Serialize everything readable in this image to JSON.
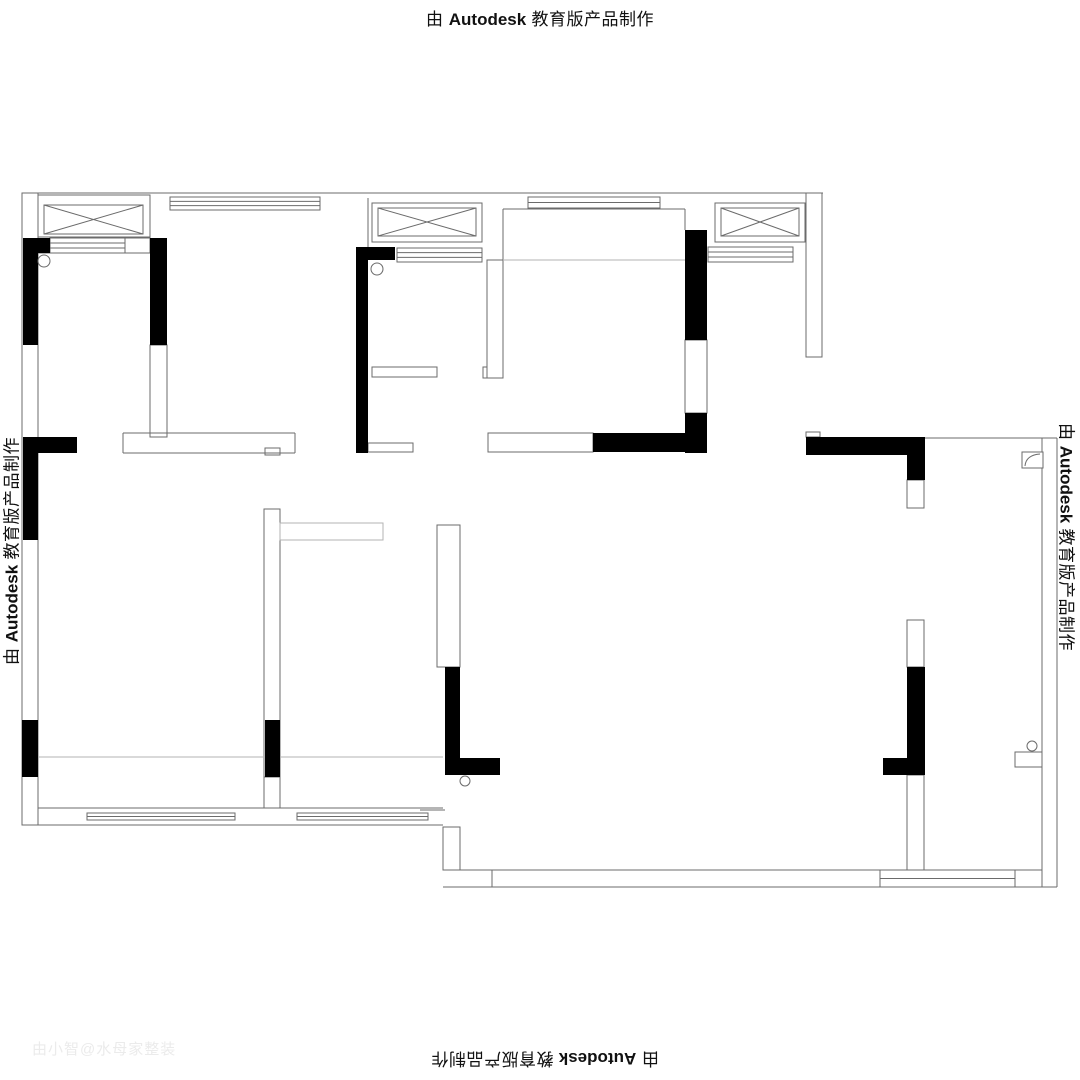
{
  "stamp": {
    "pre": "由",
    "brand": "Autodesk",
    "post": "教育版产品制作"
  },
  "watermark": {
    "text": "由小智@水母家整装"
  },
  "plan": {
    "colors": {
      "wall_fill": "#000000",
      "line": "#6b6b6b",
      "light": "#b3b3b3"
    },
    "solid_walls": [
      [
        23,
        238,
        27,
        15
      ],
      [
        23,
        238,
        15,
        107
      ],
      [
        150,
        238,
        17,
        107
      ],
      [
        356,
        247,
        12,
        206
      ],
      [
        356,
        247,
        39,
        13
      ],
      [
        685,
        230,
        22,
        110
      ],
      [
        685,
        413,
        22,
        40
      ],
      [
        593,
        433,
        92,
        19
      ],
      [
        806,
        437,
        119,
        18
      ],
      [
        907,
        455,
        18,
        25
      ],
      [
        23,
        437,
        54,
        16
      ],
      [
        23,
        437,
        15,
        103
      ],
      [
        22,
        720,
        16,
        57
      ],
      [
        265,
        720,
        15,
        57
      ],
      [
        445,
        667,
        15,
        108
      ],
      [
        460,
        758,
        40,
        17
      ],
      [
        907,
        667,
        18,
        108
      ],
      [
        883,
        758,
        24,
        17
      ]
    ],
    "outline_rects": [
      [
        22,
        193,
        16,
        632
      ],
      [
        150,
        345,
        17,
        92
      ],
      [
        685,
        340,
        22,
        73
      ],
      [
        488,
        433,
        105,
        19
      ],
      [
        806,
        193,
        16,
        164
      ],
      [
        907,
        480,
        17,
        28
      ],
      [
        907,
        620,
        17,
        47
      ],
      [
        907,
        775,
        17,
        95
      ],
      [
        437,
        525,
        23,
        142
      ],
      [
        264,
        509,
        16,
        268
      ],
      [
        264,
        777,
        16,
        31
      ],
      [
        443,
        827,
        17,
        43
      ],
      [
        372,
        367,
        65,
        10
      ],
      [
        368,
        443,
        45,
        9
      ],
      [
        806,
        432,
        14,
        5
      ],
      [
        1015,
        752,
        27,
        15
      ],
      [
        483,
        367,
        10,
        11
      ],
      [
        487,
        260,
        16,
        118
      ],
      [
        125,
        238,
        25,
        15
      ],
      [
        265,
        448,
        15,
        7
      ]
    ],
    "lines": [
      [
        22,
        193,
        823,
        193
      ],
      [
        38,
        253,
        150,
        253
      ],
      [
        123,
        433,
        295,
        433
      ],
      [
        123,
        453,
        295,
        453
      ],
      [
        123,
        433,
        123,
        453
      ],
      [
        295,
        433,
        295,
        453
      ],
      [
        503,
        209,
        685,
        209
      ],
      [
        503,
        209,
        503,
        262
      ],
      [
        685,
        209,
        685,
        230
      ],
      [
        368,
        198,
        368,
        247
      ],
      [
        925,
        438,
        1057,
        438
      ],
      [
        1042,
        438,
        1042,
        752
      ],
      [
        1042,
        767,
        1042,
        887
      ],
      [
        1057,
        438,
        1057,
        887
      ],
      [
        443,
        870,
        1042,
        870
      ],
      [
        443,
        887,
        1057,
        887
      ],
      [
        492,
        870,
        492,
        887
      ],
      [
        880,
        870,
        880,
        887
      ],
      [
        948,
        870,
        948,
        887
      ],
      [
        1015,
        870,
        1015,
        887
      ],
      [
        38,
        808,
        443,
        808
      ],
      [
        22,
        825,
        443,
        825
      ],
      [
        420,
        810,
        445,
        810
      ]
    ],
    "light_lines": [
      [
        503,
        260,
        685,
        260
      ],
      [
        38,
        757,
        263,
        757
      ],
      [
        280,
        757,
        443,
        757
      ]
    ],
    "light_rects": [
      [
        280,
        523,
        103,
        17
      ]
    ],
    "xwindows": [
      {
        "outer": [
          38,
          195,
          112,
          42
        ],
        "inner": [
          44,
          205,
          99,
          29
        ]
      },
      {
        "outer": [
          372,
          203,
          110,
          39
        ],
        "inner": [
          378,
          208,
          98,
          28
        ]
      },
      {
        "outer": [
          715,
          203,
          90,
          39
        ],
        "inner": [
          721,
          208,
          78,
          28
        ]
      }
    ],
    "sills": [
      {
        "r": [
          50,
          238,
          75,
          15
        ],
        "n": 2
      },
      {
        "r": [
          170,
          197,
          150,
          13
        ],
        "n": 2
      },
      {
        "r": [
          397,
          248,
          85,
          14
        ],
        "n": 2
      },
      {
        "r": [
          528,
          197,
          132,
          11
        ],
        "n": 1
      },
      {
        "r": [
          708,
          247,
          85,
          15
        ],
        "n": 2
      },
      {
        "r": [
          87,
          813,
          148,
          7
        ],
        "n": 1
      },
      {
        "r": [
          297,
          813,
          131,
          7
        ],
        "n": 1
      },
      {
        "r": [
          880,
          870,
          135,
          17
        ],
        "n": 1
      }
    ],
    "circles": [
      [
        44,
        261,
        6
      ],
      [
        377,
        269,
        6
      ],
      [
        465,
        781,
        5
      ],
      [
        1032,
        746,
        5
      ]
    ],
    "door_symbol": {
      "rect": [
        1022,
        452,
        21,
        16
      ]
    }
  }
}
